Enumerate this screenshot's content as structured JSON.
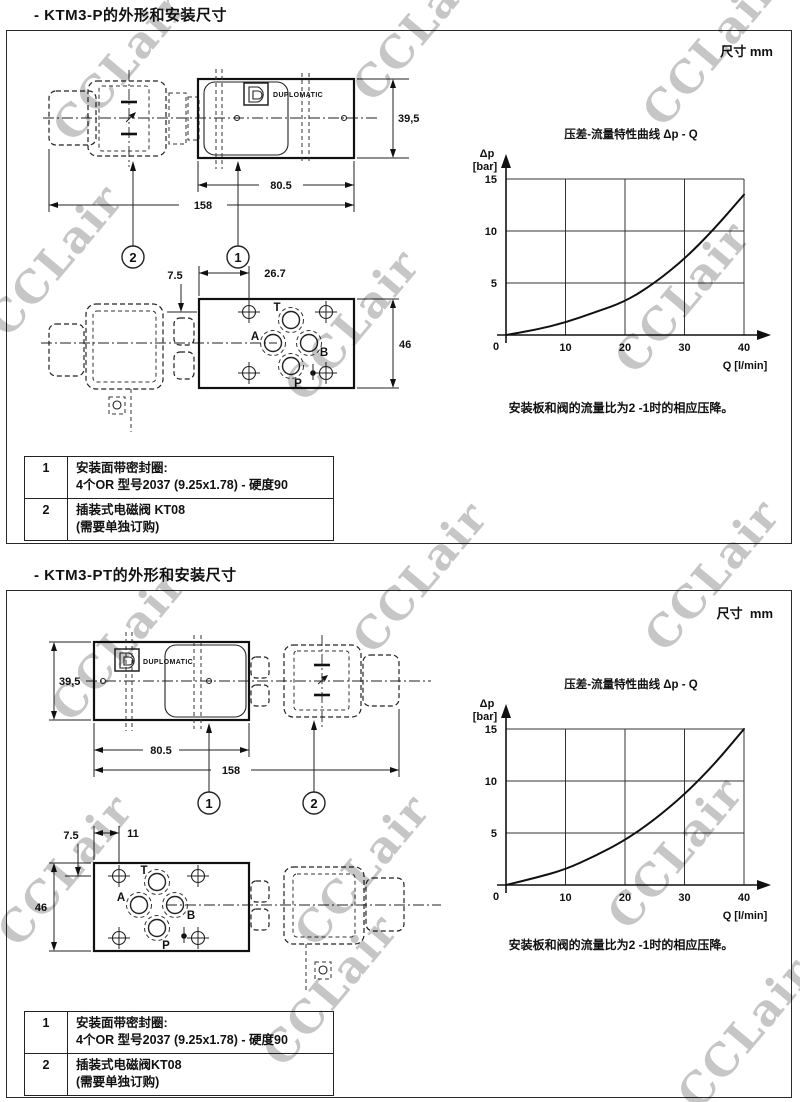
{
  "watermark": {
    "text": "CCLair",
    "color": "#c6c6c6",
    "instances": [
      {
        "x": 30,
        "y": 40
      },
      {
        "x": 330,
        "y": 0
      },
      {
        "x": 620,
        "y": 25
      },
      {
        "x": -35,
        "y": 235
      },
      {
        "x": 262,
        "y": 300
      },
      {
        "x": 592,
        "y": 272
      },
      {
        "x": 330,
        "y": 552
      },
      {
        "x": 622,
        "y": 550
      },
      {
        "x": 28,
        "y": 620
      },
      {
        "x": -25,
        "y": 845
      },
      {
        "x": 272,
        "y": 845
      },
      {
        "x": 585,
        "y": 828
      },
      {
        "x": 240,
        "y": 965
      },
      {
        "x": 655,
        "y": 1008
      }
    ]
  },
  "sections": [
    {
      "title": "- KTM3-P的外形和安装尺寸",
      "unit_label": "尺寸 mm",
      "brand": "DUPLOMATIC",
      "side_view": {
        "dim_height": "39,5",
        "dim_body": "80.5",
        "dim_total": "158",
        "callout_left": "2",
        "callout_right": "1"
      },
      "top_view": {
        "dim_edge": "7.5",
        "dim_hole": "26.7",
        "dim_height": "46",
        "ports": {
          "t": "T",
          "a": "A",
          "b": "B",
          "p": "P"
        }
      },
      "chart_note": "安装板和阀的流量比为2 -1时的相应压降。",
      "notes": [
        {
          "num": "1",
          "line1": "安装面带密封圈:",
          "line2": "4个OR 型号2037 (9.25x1.78) - 硬度90"
        },
        {
          "num": "2",
          "line1": "插装式电磁阀 KT08",
          "line2": "(需要单独订购)"
        }
      ]
    },
    {
      "title": "- KTM3-PT的外形和安装尺寸",
      "unit_label": "尺寸  mm",
      "brand": "DUPLOMATIC",
      "side_view": {
        "dim_height": "39,5",
        "dim_body": "80.5",
        "dim_total": "158",
        "callout_left": "1",
        "callout_right": "2"
      },
      "top_view": {
        "dim_edge": "7.5",
        "dim_hole": "11",
        "dim_height": "46",
        "ports": {
          "t": "T",
          "a": "A",
          "b": "B",
          "p": "P"
        }
      },
      "chart_note": "安装板和阀的流量比为2 -1时的相应压降。",
      "notes": [
        {
          "num": "1",
          "line1": "安装面带密封圈:",
          "line2": "4个OR 型号2037 (9.25x1.78) - 硬度90"
        },
        {
          "num": "2",
          "line1": "插装式电磁阀KT08",
          "line2": "(需要单独订购)"
        }
      ]
    }
  ],
  "chart_data": [
    {
      "type": "line",
      "title": "压差-流量特性曲线 Δp - Q",
      "ylabel_line1": "Δp",
      "ylabel_line2": "[bar]",
      "xlabel": "Q [l/min]",
      "x": [
        0,
        5,
        10,
        15,
        20,
        25,
        30,
        35,
        40
      ],
      "series": [
        {
          "name": "Δp",
          "values": [
            0,
            0.5,
            1.2,
            2.2,
            3.2,
            5.0,
            7.3,
            10.2,
            13.5
          ]
        }
      ],
      "xlim": [
        0,
        40
      ],
      "ylim": [
        0,
        15
      ],
      "xticks": [
        "0",
        "10",
        "20",
        "30",
        "40"
      ],
      "yticks": [
        "5",
        "10",
        "15"
      ],
      "grid": true,
      "legend": false
    },
    {
      "type": "line",
      "title": "压差-流量特性曲线 Δp - Q",
      "ylabel_line1": "Δp",
      "ylabel_line2": "[bar]",
      "xlabel": "Q [l/min]",
      "x": [
        0,
        5,
        10,
        15,
        20,
        25,
        30,
        35,
        40
      ],
      "series": [
        {
          "name": "Δp",
          "values": [
            0,
            0.7,
            1.5,
            2.8,
            4.3,
            6.3,
            8.7,
            11.6,
            15.0
          ]
        }
      ],
      "xlim": [
        0,
        40
      ],
      "ylim": [
        0,
        15
      ],
      "xticks": [
        "0",
        "10",
        "20",
        "30",
        "40"
      ],
      "yticks": [
        "5",
        "10",
        "15"
      ],
      "grid": true,
      "legend": false
    }
  ]
}
